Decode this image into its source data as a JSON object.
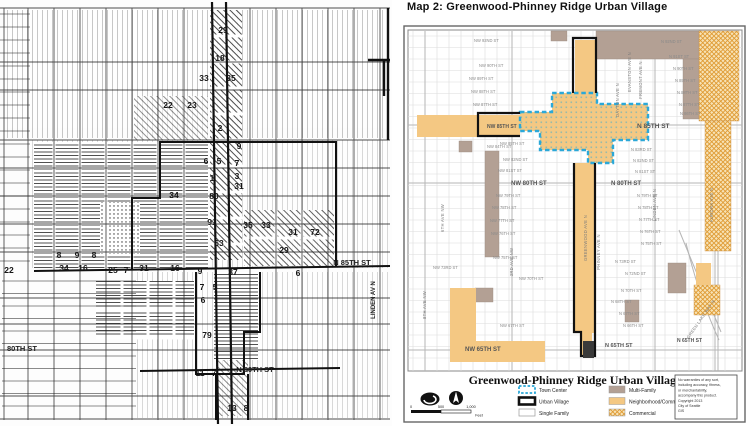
{
  "right_map": {
    "title": "Map 2: Greenwood-Phinney Ridge Urban Village",
    "street_labels_big": [
      {
        "t": "N 85TH ST",
        "x": 238,
        "y": 128,
        "s": 6.5,
        "c": "#3a3a3a"
      },
      {
        "t": "NW 85TH ST",
        "x": 88,
        "y": 128,
        "s": 5,
        "c": "#222"
      },
      {
        "t": "NW 80TH ST",
        "x": 112,
        "y": 185,
        "s": 6,
        "c": "#555"
      },
      {
        "t": "N 80TH ST",
        "x": 212,
        "y": 185,
        "s": 6,
        "c": "#555"
      },
      {
        "t": "NW 65TH ST",
        "x": 66,
        "y": 351,
        "s": 6,
        "c": "#444"
      },
      {
        "t": "N 65TH ST",
        "x": 206,
        "y": 347,
        "s": 5.5,
        "c": "#555"
      },
      {
        "t": "N 65TH ST",
        "x": 278,
        "y": 342,
        "s": 5,
        "c": "#555"
      }
    ],
    "street_labels_small": [
      {
        "t": "NW 92ND ST",
        "x": 75,
        "y": 42
      },
      {
        "t": "NW 90TH ST",
        "x": 80,
        "y": 67
      },
      {
        "t": "NW 89TH ST",
        "x": 70,
        "y": 80
      },
      {
        "t": "NW 88TH ST",
        "x": 72,
        "y": 93
      },
      {
        "t": "NW 87TH ST",
        "x": 74,
        "y": 106
      },
      {
        "t": "NW 85TH ST",
        "x": 101,
        "y": 145
      },
      {
        "t": "NW 84TH ST",
        "x": 88,
        "y": 148
      },
      {
        "t": "NW 82ND ST",
        "x": 104,
        "y": 161
      },
      {
        "t": "NW 81ST ST",
        "x": 99,
        "y": 172
      },
      {
        "t": "NW 79TH ST",
        "x": 97,
        "y": 197
      },
      {
        "t": "NW 78TH ST",
        "x": 93,
        "y": 209
      },
      {
        "t": "NW 77TH ST",
        "x": 91,
        "y": 222
      },
      {
        "t": "NW 76TH ST",
        "x": 92,
        "y": 235
      },
      {
        "t": "NW 75TH ST",
        "x": 94,
        "y": 259
      },
      {
        "t": "NW 73RD ST",
        "x": 34,
        "y": 269
      },
      {
        "t": "NW 70TH ST",
        "x": 120,
        "y": 280
      },
      {
        "t": "NW 67TH ST",
        "x": 101,
        "y": 327
      },
      {
        "t": "N 92ND ST",
        "x": 262,
        "y": 43
      },
      {
        "t": "N 91ST ST",
        "x": 270,
        "y": 58
      },
      {
        "t": "N 90TH ST",
        "x": 274,
        "y": 70
      },
      {
        "t": "N 89TH ST",
        "x": 276,
        "y": 82
      },
      {
        "t": "N 88TH ST",
        "x": 278,
        "y": 94
      },
      {
        "t": "N 87TH ST",
        "x": 280,
        "y": 106
      },
      {
        "t": "N 86TH ST",
        "x": 281,
        "y": 115
      },
      {
        "t": "N 83RD ST",
        "x": 232,
        "y": 151
      },
      {
        "t": "N 82ND ST",
        "x": 234,
        "y": 162
      },
      {
        "t": "N 81ST ST",
        "x": 236,
        "y": 173
      },
      {
        "t": "N 79TH ST",
        "x": 238,
        "y": 197
      },
      {
        "t": "N 78TH ST",
        "x": 239,
        "y": 209
      },
      {
        "t": "N 77TH ST",
        "x": 240,
        "y": 221
      },
      {
        "t": "N 76TH ST",
        "x": 241,
        "y": 233
      },
      {
        "t": "N 75TH ST",
        "x": 242,
        "y": 245
      },
      {
        "t": "N 73RD ST",
        "x": 216,
        "y": 263
      },
      {
        "t": "N 72ND ST",
        "x": 226,
        "y": 275
      },
      {
        "t": "N 70TH ST",
        "x": 222,
        "y": 292
      },
      {
        "t": "N 68TH ST",
        "x": 212,
        "y": 303
      },
      {
        "t": "N 67TH ST",
        "x": 220,
        "y": 315
      },
      {
        "t": "N 66TH ST",
        "x": 224,
        "y": 327
      }
    ],
    "avenue_labels": [
      {
        "t": "8TH AVE NW",
        "x": 27,
        "y": 305,
        "rot": -90
      },
      {
        "t": "6TH AVE NW",
        "x": 45,
        "y": 218,
        "rot": -90
      },
      {
        "t": "3RD AVE NW",
        "x": 114,
        "y": 262,
        "rot": -90
      },
      {
        "t": "GREENWOOD AVE N",
        "x": 188,
        "y": 238,
        "rot": -90,
        "c": "#3a3a3a"
      },
      {
        "t": "PHINNEY AVE N",
        "x": 201,
        "y": 252,
        "rot": -90
      },
      {
        "t": "EVANSTON AVE N",
        "x": 232,
        "y": 72,
        "rot": -90
      },
      {
        "t": "DAYTON AVE N",
        "x": 220,
        "y": 100,
        "rot": -90
      },
      {
        "t": "FREMONT AVE N",
        "x": 243,
        "y": 80,
        "rot": -90
      },
      {
        "t": "LINDEN AVE N",
        "x": 257,
        "y": 205,
        "rot": -90
      },
      {
        "t": "AURORA AVE N",
        "x": 314,
        "y": 205,
        "rot": -90
      },
      {
        "t": "GREEN LAKE WAY N",
        "x": 303,
        "y": 320,
        "rot": -55
      }
    ]
  },
  "left_map": {
    "street_labels": [
      {
        "t": "N 85TH ST",
        "x": 352,
        "y": 265,
        "s": 7.5,
        "b": 1
      },
      {
        "t": "N 80TH ST",
        "x": 255,
        "y": 372,
        "s": 7.5,
        "b": 1
      },
      {
        "t": "80TH ST",
        "x": 22,
        "y": 351,
        "s": 7.5,
        "b": 1
      },
      {
        "t": "LINDEN AV N",
        "x": 375,
        "y": 300,
        "s": 6,
        "rot": -90
      }
    ],
    "block_numbers": [
      [
        223,
        33,
        "29"
      ],
      [
        220,
        61,
        "18"
      ],
      [
        204,
        81,
        "33"
      ],
      [
        231,
        81,
        "35"
      ],
      [
        168,
        108,
        "22"
      ],
      [
        192,
        108,
        "23"
      ],
      [
        220,
        131,
        "2"
      ],
      [
        239,
        149,
        "9"
      ],
      [
        206,
        164,
        "6"
      ],
      [
        219,
        164,
        "5"
      ],
      [
        237,
        166,
        "7"
      ],
      [
        212,
        181,
        "1"
      ],
      [
        237,
        179,
        "3"
      ],
      [
        174,
        198,
        "34"
      ],
      [
        214,
        199,
        "80"
      ],
      [
        239,
        189,
        "31"
      ],
      [
        212,
        225,
        "91"
      ],
      [
        248,
        228,
        "35"
      ],
      [
        266,
        228,
        "33"
      ],
      [
        293,
        235,
        "31"
      ],
      [
        315,
        235,
        "72"
      ],
      [
        284,
        253,
        "29"
      ],
      [
        219,
        246,
        "63"
      ],
      [
        59,
        258,
        "8"
      ],
      [
        77,
        258,
        "9"
      ],
      [
        94,
        258,
        "8"
      ],
      [
        64,
        271,
        "34"
      ],
      [
        83,
        271,
        "16"
      ],
      [
        113,
        273,
        "25"
      ],
      [
        126,
        273,
        "7"
      ],
      [
        144,
        271,
        "31"
      ],
      [
        175,
        271,
        "16"
      ],
      [
        9,
        273,
        "22"
      ],
      [
        200,
        274,
        "9"
      ],
      [
        233,
        275,
        "37"
      ],
      [
        298,
        276,
        "6"
      ],
      [
        202,
        290,
        "7"
      ],
      [
        215,
        290,
        "5"
      ],
      [
        203,
        303,
        "6"
      ],
      [
        207,
        338,
        "79"
      ],
      [
        200,
        376,
        "11"
      ],
      [
        214,
        376,
        "7"
      ],
      [
        232,
        411,
        "13"
      ],
      [
        246,
        411,
        "8"
      ]
    ]
  },
  "legend": {
    "title": "Greenwood-Phinney Ridge Urban Village",
    "columns": [
      [
        {
          "label": "Town Center",
          "swatch": "town-center"
        },
        {
          "label": "Urban Village",
          "swatch": "urban-village"
        },
        {
          "label": "Single Family",
          "swatch": "single-family"
        }
      ],
      [
        {
          "label": "Multi-Family",
          "swatch": "multi-family"
        },
        {
          "label": "Neighborhood/Commercial",
          "swatch": "neighborhood-commercial"
        },
        {
          "label": "Commercial",
          "swatch": "commercial"
        }
      ]
    ],
    "scale_ticks": [
      "0",
      "500",
      "1,000"
    ],
    "scale_unit": "Feet",
    "disclaimer_lines": [
      "No warranties of any sort,",
      "including accuracy, fitness,",
      "or merchantability,",
      "accompany this product.",
      "Copyright 2013",
      "City of Seattle",
      "GIS"
    ]
  },
  "colors": {
    "town_center_blue": "#2BA8D8",
    "neighborhood_commercial": "#F4C883",
    "multi_family": "#B3A094",
    "commercial_hatch": "#DF9A33",
    "urban_village": "#111111"
  }
}
